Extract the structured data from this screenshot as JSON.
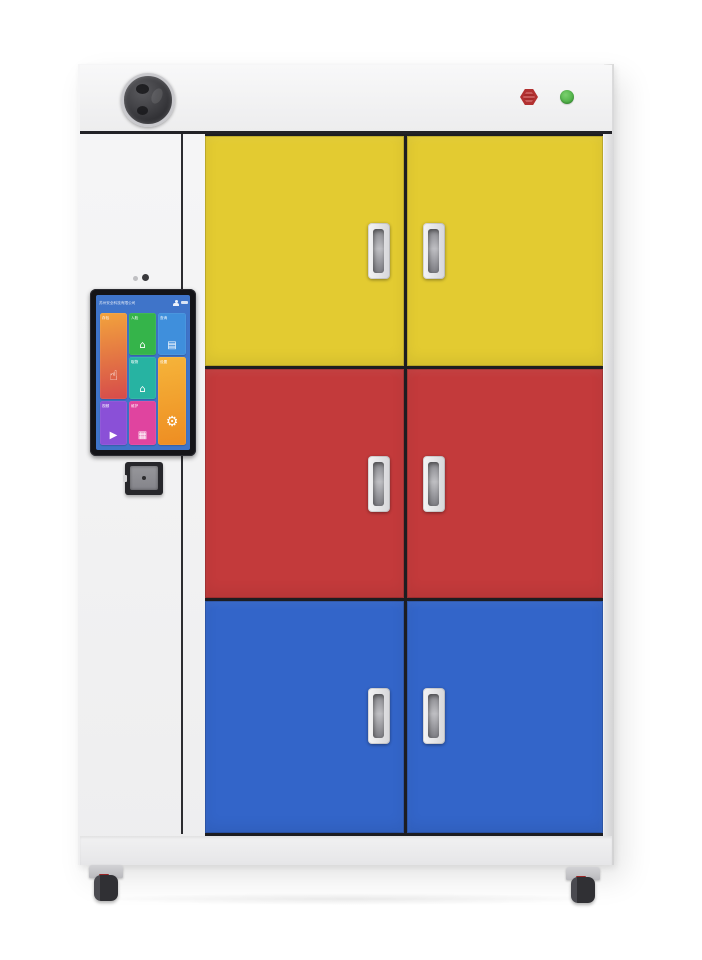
{
  "colors": {
    "cabinet_body": "#f4f4f5",
    "door_yellow": "#e3cb31",
    "door_red": "#c33a3b",
    "door_blue": "#3365c9",
    "frame_dark": "#1d1d21",
    "alarm_red": "#b23131",
    "indicator_green": "#4aae43",
    "screen_blue": "#3f74c9"
  },
  "screen": {
    "company_name": "苏州安全科技有限公司",
    "tiles": [
      {
        "label": "存包",
        "glyph": "☝",
        "bg": "linear-gradient(170deg,#f2a33c,#d64b4b)"
      },
      {
        "label": "人脸",
        "glyph": "⌂",
        "bg": "#35b44a"
      },
      {
        "label": "查询",
        "glyph": "▤",
        "bg": "#3f8fdc"
      },
      {
        "label": "取物",
        "glyph": "⌂",
        "bg": "#27b3a2"
      },
      {
        "label": "设置",
        "glyph": "⚙",
        "bg": "linear-gradient(170deg,#f5b43a,#ee8d22)"
      },
      {
        "label": "视频",
        "glyph": "▶",
        "bg": "#8a50d7"
      },
      {
        "label": "维护",
        "glyph": "▦",
        "bg": "#e0449f"
      }
    ]
  }
}
